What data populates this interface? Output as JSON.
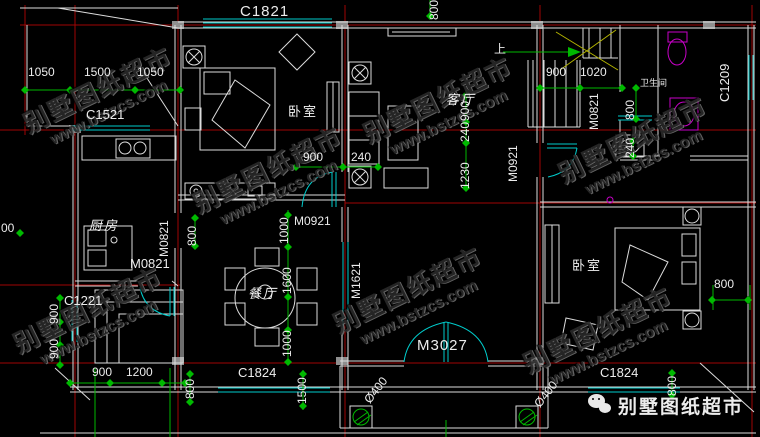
{
  "windows": {
    "c1821": "C1821",
    "c1521": "C1521",
    "c1209": "C1209",
    "c1221": "C1221",
    "c1824_left": "C1824",
    "c1824_right": "C1824"
  },
  "doors": {
    "m3027": "M3027",
    "m0921_hall": "M0921",
    "m0921_stair": "M0921",
    "m0821_stair": "M0821",
    "m0821_kitchen": "M0821",
    "m0821_kitchen_side": "M0821",
    "m1621": "M1621"
  },
  "rooms": {
    "bedroom_top": "卧室",
    "bedroom_right": "卧室",
    "living": "客厅",
    "dining": "餐厅",
    "kitchen": "厨房",
    "bathroom": "卫生间"
  },
  "stairs": {
    "direction": "上"
  },
  "dims": {
    "d1050": "1050",
    "d1500": "1500",
    "d900": "900",
    "d1020": "1020",
    "d800": "800",
    "d240": "240",
    "d1230": "1230",
    "d1000": "1000",
    "d1600": "1600",
    "d1200": "1200",
    "d1500_porch": "1500",
    "phi400": "Ø400",
    "d00": "00"
  },
  "watermark": {
    "brand": "别墅图纸超市",
    "site": "www.bstzcs.com"
  },
  "footer": {
    "brand": "别墅图纸超市"
  },
  "colors": {
    "grid_axis": "#a00505",
    "walls": "#dcdcdc",
    "windows_doors": "#00cdcd",
    "dimensions": "#00b900",
    "fixtures": "#c800c8",
    "stairs": "#b4b400"
  }
}
